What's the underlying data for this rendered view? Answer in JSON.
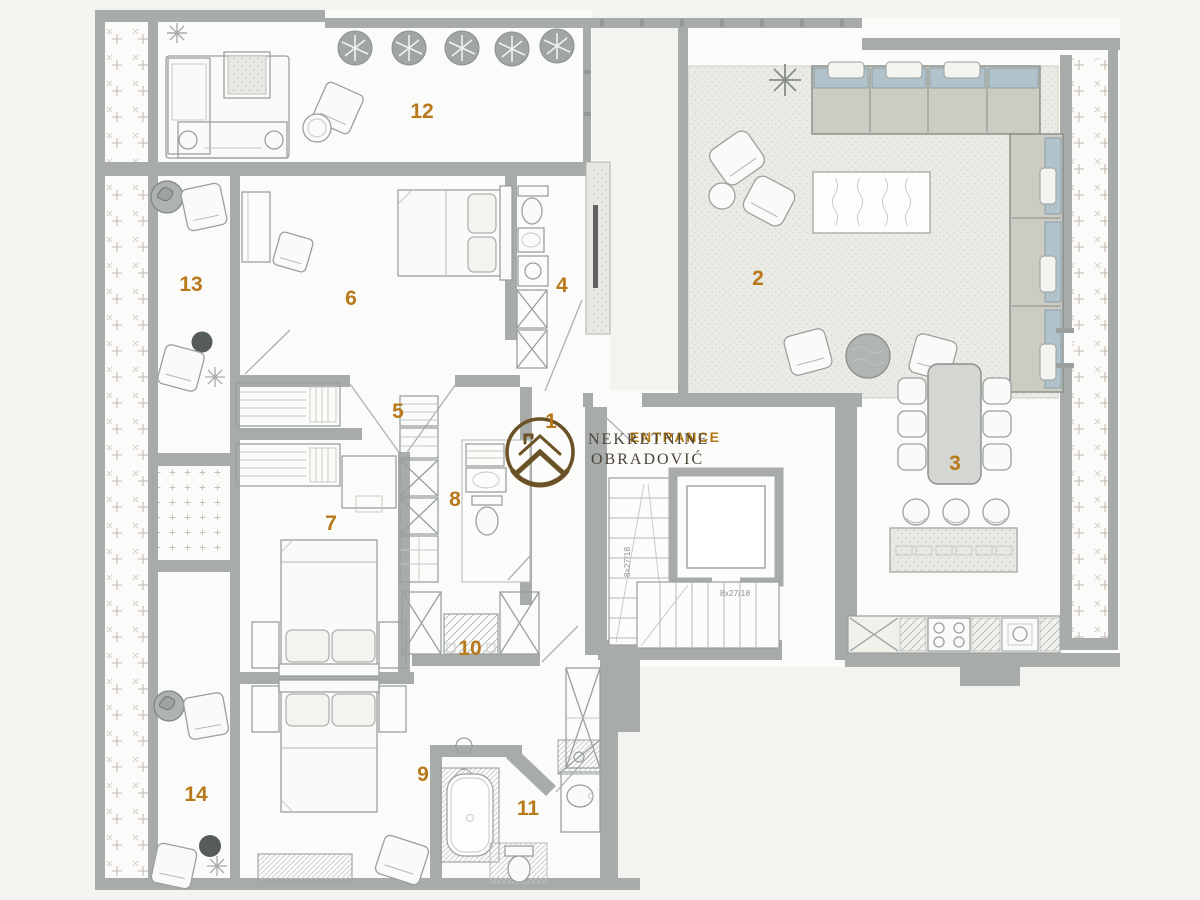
{
  "watermark": {
    "line1": "NEKRETNINE",
    "line2": "OBRADOVIĆ"
  },
  "entrance": {
    "label": "ENTRANCE"
  },
  "stairs": {
    "flight_a": "8x27/18",
    "flight_b": "8x27/18"
  },
  "rooms": [
    {
      "number": "1"
    },
    {
      "number": "2"
    },
    {
      "number": "3"
    },
    {
      "number": "4"
    },
    {
      "number": "5"
    },
    {
      "number": "6"
    },
    {
      "number": "7"
    },
    {
      "number": "8"
    },
    {
      "number": "9"
    },
    {
      "number": "10"
    },
    {
      "number": "11"
    },
    {
      "number": "12"
    },
    {
      "number": "13"
    },
    {
      "number": "14"
    }
  ],
  "colors": {
    "room_number": "#b8791b",
    "entrance": "#b0760e",
    "logo": "#6b5226",
    "watermark_text": "#4b4337",
    "wall": "#a7acaa"
  }
}
